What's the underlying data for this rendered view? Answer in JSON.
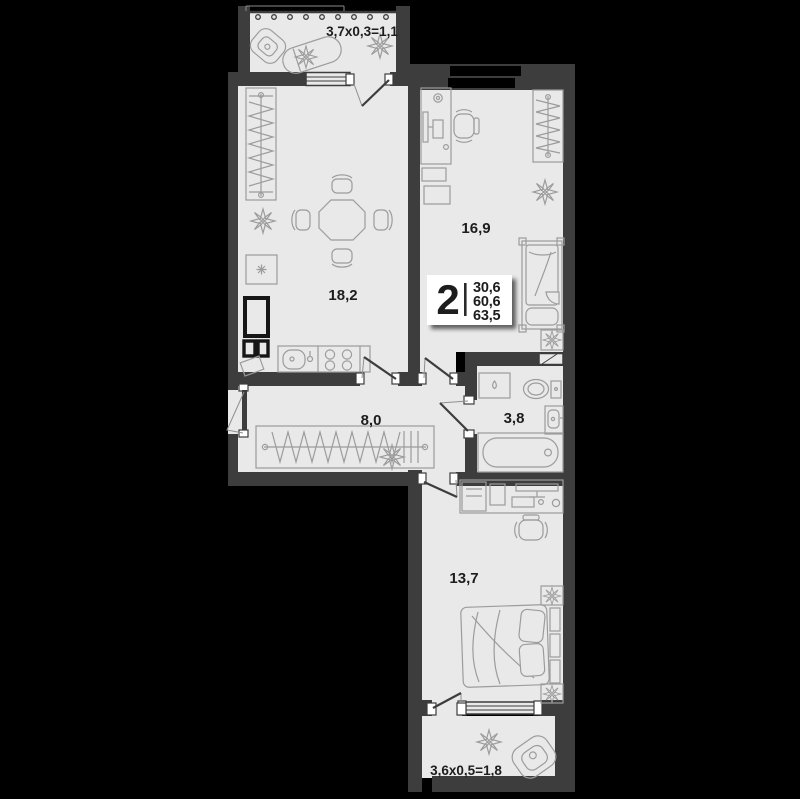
{
  "page": {
    "background_color": "#000000",
    "type": "apartment-floor-plan"
  },
  "plan": {
    "summary_badge": {
      "room_count": "2",
      "living_area": "30,6",
      "floor_area": "60,6",
      "total_area": "63,5"
    },
    "rooms": [
      {
        "name": "kitchen-living-room",
        "area_label": "18,2",
        "furniture": [
          "wardrobe",
          "dining-table",
          "four-chairs",
          "fridge",
          "kitchen-sink",
          "stove",
          "plant",
          "duct-shaft"
        ]
      },
      {
        "name": "bedroom-top",
        "area_label": "16,9",
        "furniture": [
          "desk",
          "office-chair",
          "drawer-unit",
          "wardrobe",
          "single-bed",
          "nightstand",
          "plant"
        ]
      },
      {
        "name": "hallway",
        "area_label": "8,0",
        "furniture": [
          "open-wardrobe-with-hangers",
          "plant"
        ]
      },
      {
        "name": "bathroom",
        "area_label": "3,8",
        "furniture": [
          "washing-machine",
          "toilet",
          "sink",
          "bathtub"
        ]
      },
      {
        "name": "bedroom-bottom",
        "area_label": "13,7",
        "furniture": [
          "desk",
          "office-chair",
          "double-bed",
          "nightstand",
          "nightstand",
          "plant",
          "plant"
        ]
      }
    ],
    "balconies": [
      {
        "name": "balcony-top",
        "dimension_label": "3,7x0,3=1,1",
        "furniture": [
          "chair",
          "bench",
          "plant"
        ]
      },
      {
        "name": "balcony-bottom",
        "dimension_label": "3,6x0,5=1,8",
        "furniture": [
          "armchair",
          "plant"
        ]
      }
    ],
    "colors": {
      "background": "#000000",
      "wall": "#3d3d3d",
      "floor": "#e9e9e9",
      "furniture_line": "#9c9c9c",
      "label_text": "#1d1d1d",
      "badge_background": "#ffffff",
      "window_glass": "#000000"
    }
  }
}
